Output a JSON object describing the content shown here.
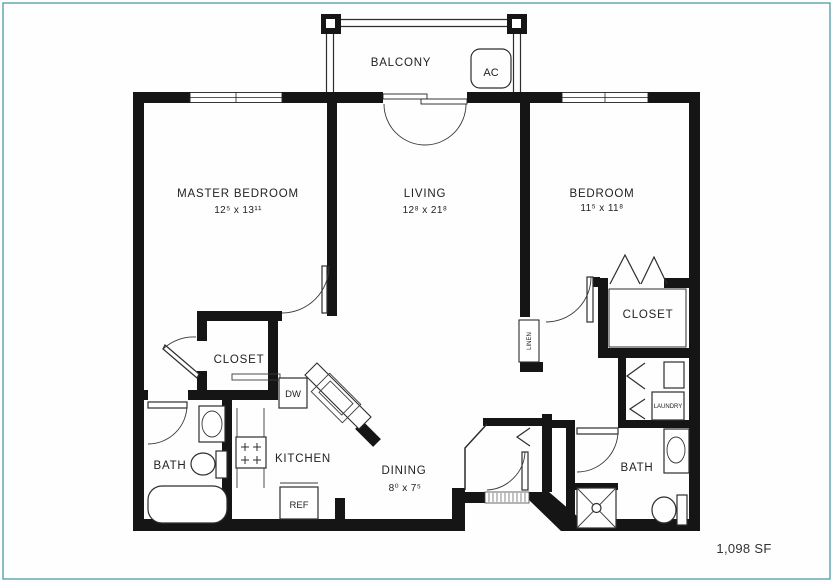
{
  "frame": {
    "border_color": "#4d9ca6"
  },
  "plan": {
    "area": "1,098 SF",
    "balcony": {
      "label": "BALCONY",
      "ac": "AC"
    },
    "rooms": {
      "master_bedroom": {
        "name": "MASTER BEDROOM",
        "dims": "12⁵ x 13¹¹"
      },
      "living": {
        "name": "LIVING",
        "dims": "12⁸ x 21⁸"
      },
      "bedroom": {
        "name": "BEDROOM",
        "dims": "11⁵ x 11⁸"
      },
      "dining": {
        "name": "DINING",
        "dims": "8⁰ x 7⁵"
      },
      "kitchen": {
        "name": "KITCHEN"
      },
      "master_bath": {
        "name": "BATH"
      },
      "bath": {
        "name": "BATH"
      },
      "master_closet": {
        "name": "CLOSET"
      },
      "bedroom_closet": {
        "name": "CLOSET"
      },
      "linen": {
        "name": "LINEN"
      },
      "laundry": {
        "name": "LAUNDRY"
      }
    },
    "appliances": {
      "dishwasher": "DW",
      "refrigerator": "REF"
    },
    "colors": {
      "wall": "#151515",
      "line": "#2d2d2d",
      "text": "#222222"
    }
  }
}
